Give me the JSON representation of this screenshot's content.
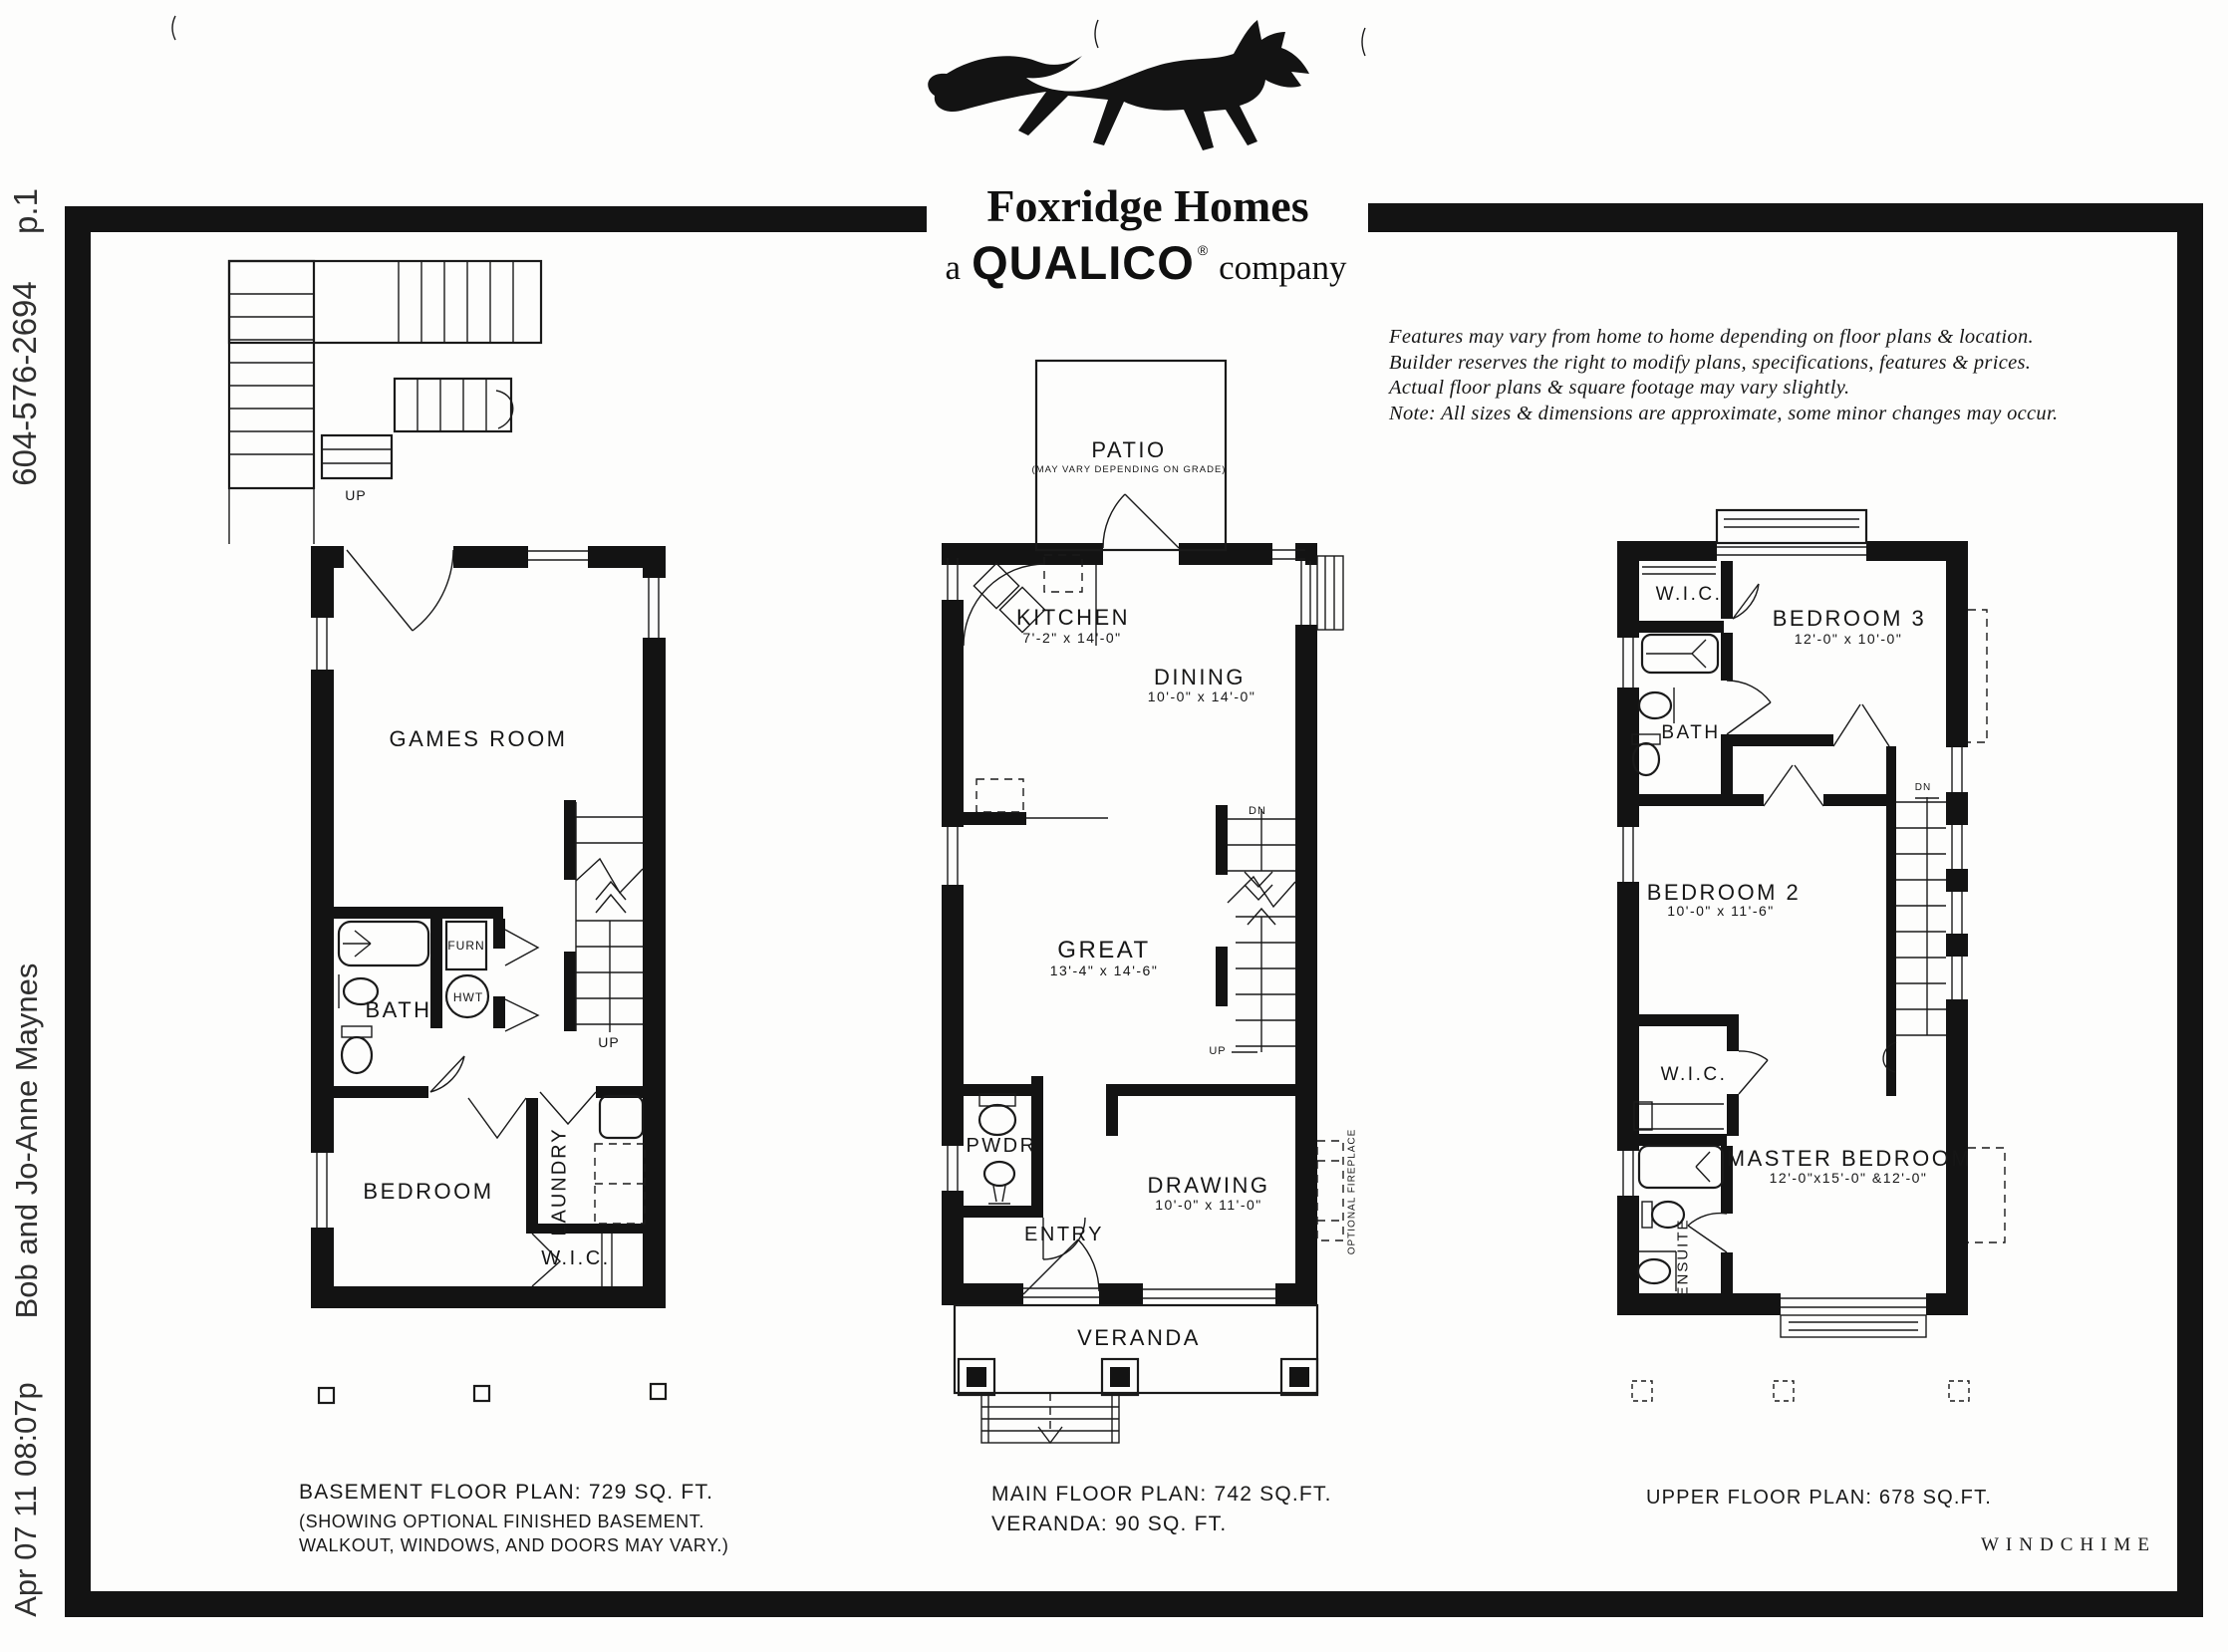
{
  "fax_header": {
    "page": "p.1",
    "phone": "604-576-2694",
    "sender": "Bob and Jo-Anne Maynes",
    "datetime": "Apr 07 11 08:07p"
  },
  "logo": {
    "company": "Foxridge Homes",
    "tagline_prefix": "a",
    "tagline_brand": "QUALICO",
    "tagline_reg": "®",
    "tagline_suffix": "company"
  },
  "disclaimer": {
    "line1": "Features may vary from home to home depending on floor plans & location.",
    "line2": "Builder reserves the right to modify plans, specifications, features & prices.",
    "line3": "Actual floor plans & square footage may vary slightly.",
    "line4": "Note: All sizes & dimensions are approximate, some minor changes may occur."
  },
  "plans": {
    "basement": {
      "labels": {
        "games_room": "GAMES ROOM",
        "bath": "BATH",
        "furn": "FURN",
        "hwt": "HWT",
        "up_top": "UP",
        "up_mid": "UP",
        "bedroom": "BEDROOM",
        "laundry": "LAUNDRY",
        "wic": "W.I.C."
      },
      "caption": {
        "line1": "BASEMENT FLOOR PLAN:  729 SQ. FT.",
        "line2": "(SHOWING OPTIONAL FINISHED BASEMENT.",
        "line3": "WALKOUT, WINDOWS, AND DOORS MAY VARY.)"
      }
    },
    "main": {
      "labels": {
        "patio": "PATIO",
        "patio_note": "(MAY VARY DEPENDING ON GRADE)",
        "kitchen": "KITCHEN",
        "kitchen_dim": "7'-2\" x 14'-0\"",
        "dining": "DINING",
        "dining_dim": "10'-0\" x 14'-0\"",
        "great": "GREAT",
        "great_dim": "13'-4\" x 14'-6\"",
        "dn": "DN",
        "up": "UP",
        "pwdr": "PWDR",
        "entry": "ENTRY",
        "drawing": "DRAWING",
        "drawing_dim": "10'-0\" x 11'-0\"",
        "optional_fireplace": "OPTIONAL FIREPLACE",
        "veranda": "VERANDA"
      },
      "caption": {
        "line1": "MAIN FLOOR PLAN: 742 SQ.FT.",
        "line2": "VERANDA: 90 SQ. FT."
      }
    },
    "upper": {
      "labels": {
        "wic_top": "W.I.C.",
        "bedroom3": "BEDROOM 3",
        "bedroom3_dim": "12'-0\" x 10'-0\"",
        "bath": "BATH",
        "dn": "DN",
        "bedroom2": "BEDROOM 2",
        "bedroom2_dim": "10'-0\" x 11'-6\"",
        "wic_lower": "W.I.C.",
        "master": "MASTER BEDROOM",
        "master_dim": "12'-0\"x15'-0\" &12'-0\"",
        "ensuite": "ENSUITE"
      },
      "caption": "UPPER FLOOR PLAN: 678 SQ.FT."
    }
  },
  "footer": {
    "model": "WINDCHIME"
  }
}
